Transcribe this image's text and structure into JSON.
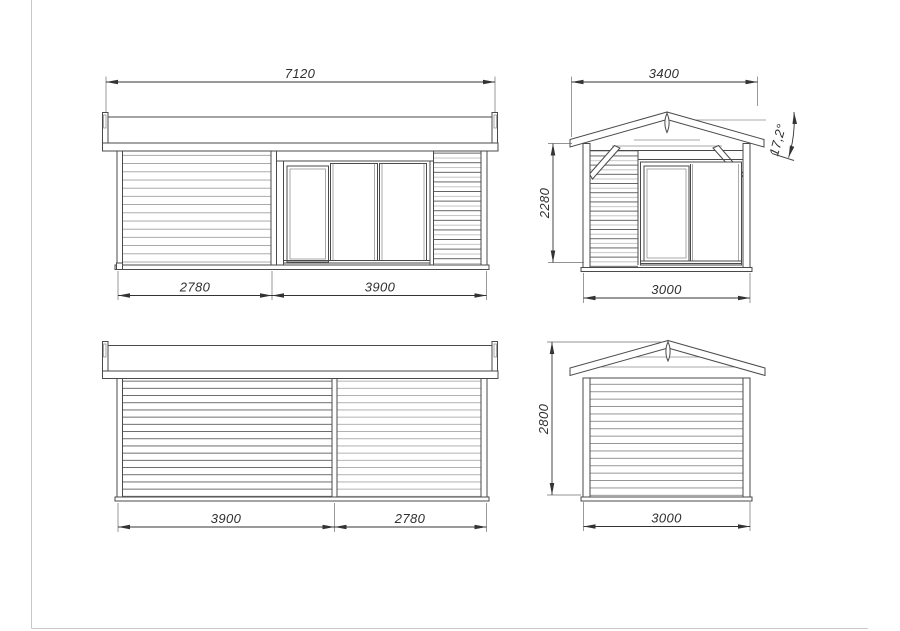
{
  "sheet": {
    "type": "technical-drawing",
    "subject": "garden house elevation drawings",
    "page_border_color": "#c9c9c9",
    "line_color": "#4a4a4a",
    "dim_color": "#2f2f2f"
  },
  "views": {
    "front": {
      "width_total": "7120",
      "section_left": "2780",
      "section_right": "3900"
    },
    "side_door": {
      "roof_width": "3400",
      "wall_height": "2280",
      "base_width": "3000",
      "roof_angle": "17,2°"
    },
    "rear": {
      "section_left": "3900",
      "section_right": "2780"
    },
    "side_solid": {
      "height_total": "2800",
      "base_width": "3000"
    }
  }
}
